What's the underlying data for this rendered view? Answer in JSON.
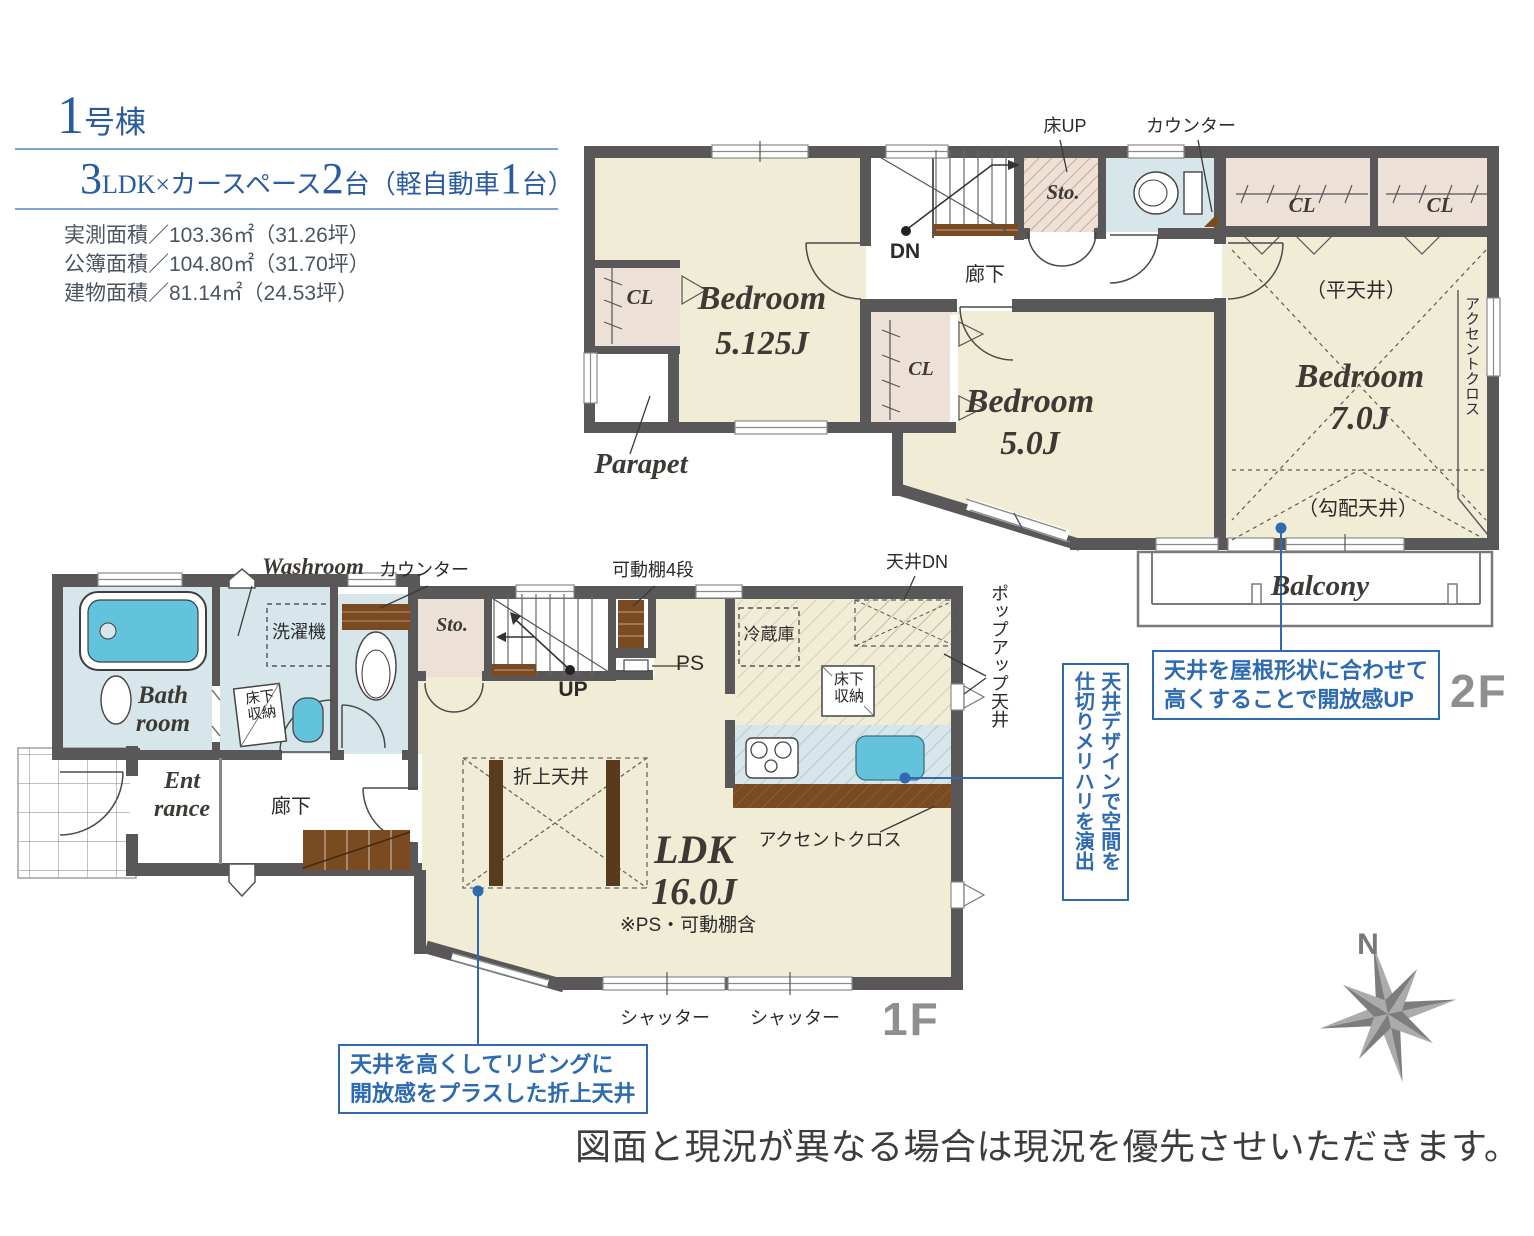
{
  "header": {
    "building_num": "1",
    "building_suffix": "号棟",
    "spec": [
      "3",
      "LDK×カースペース",
      "2",
      "台（軽自動車",
      "1",
      "台）"
    ],
    "area_lines": [
      "実測面積／103.36㎡（31.26坪）",
      "公簿面積／104.80㎡（31.70坪）",
      "建物面積／81.14㎡（24.53坪）"
    ]
  },
  "f2": {
    "floor_label": "2F",
    "bedroom1_name": "Bedroom",
    "bedroom1_size": "5.125J",
    "bedroom2_name": "Bedroom",
    "bedroom2_size": "5.0J",
    "bedroom3_name": "Bedroom",
    "bedroom3_size": "7.0J",
    "cl": "CL",
    "sto": "Sto.",
    "parapet": "Parapet",
    "balcony": "Balcony",
    "hallway": "廊下",
    "dn": "DN",
    "floor_up": "床UP",
    "counter": "カウンター",
    "flat_ceiling": "（平天井）",
    "sloped_ceiling": "（勾配天井）",
    "accent_cloth": "アクセントクロス"
  },
  "f1": {
    "floor_label": "1F",
    "bath_line1": "Bath",
    "bath_line2": "room",
    "washroom": "Washroom",
    "counter": "カウンター",
    "laundry": "洗濯機",
    "underfloor": "床下収納",
    "entrance_line1": "Ent",
    "entrance_line2": "rance",
    "hallway": "廊下",
    "sto": "Sto.",
    "up": "UP",
    "ps": "PS",
    "shelf": "可動棚4段",
    "fridge": "冷蔵庫",
    "ceiling_dn": "天井DN",
    "popup_ceiling": "ポップアップ天井",
    "accent_cloth": "アクセントクロス",
    "coffered": "折上天井",
    "ldk_name": "LDK",
    "ldk_size": "16.0J",
    "ldk_note": "※PS・可動棚含",
    "shutter": "シャッター"
  },
  "callouts": {
    "ldk_line1": "天井を高くしてリビングに",
    "ldk_line2": "開放感をプラスした折上天井",
    "bedroom_line1": "天井を屋根形状に合わせて",
    "bedroom_line2": "高くすることで開放感UP",
    "kitchen_line1": "天井デザインで空間を",
    "kitchen_line2": "仕切りメリハリを演出"
  },
  "compass": {
    "north": "N"
  },
  "footer": "図面と現況が異なる場合は現況を優先させいただきます。",
  "colors": {
    "wall": "#595757",
    "room_cream": "#F1ECD6",
    "closet_pink": "#EDE1D7",
    "water_blue": "#D7E6EA",
    "fixture_aqua": "#63C3DC",
    "wood_brown": "#7A4A21",
    "callout_blue": "#2D6AB0",
    "heading_blue": "#2A5B9E",
    "floor_label_gray": "#8F8F8F"
  }
}
